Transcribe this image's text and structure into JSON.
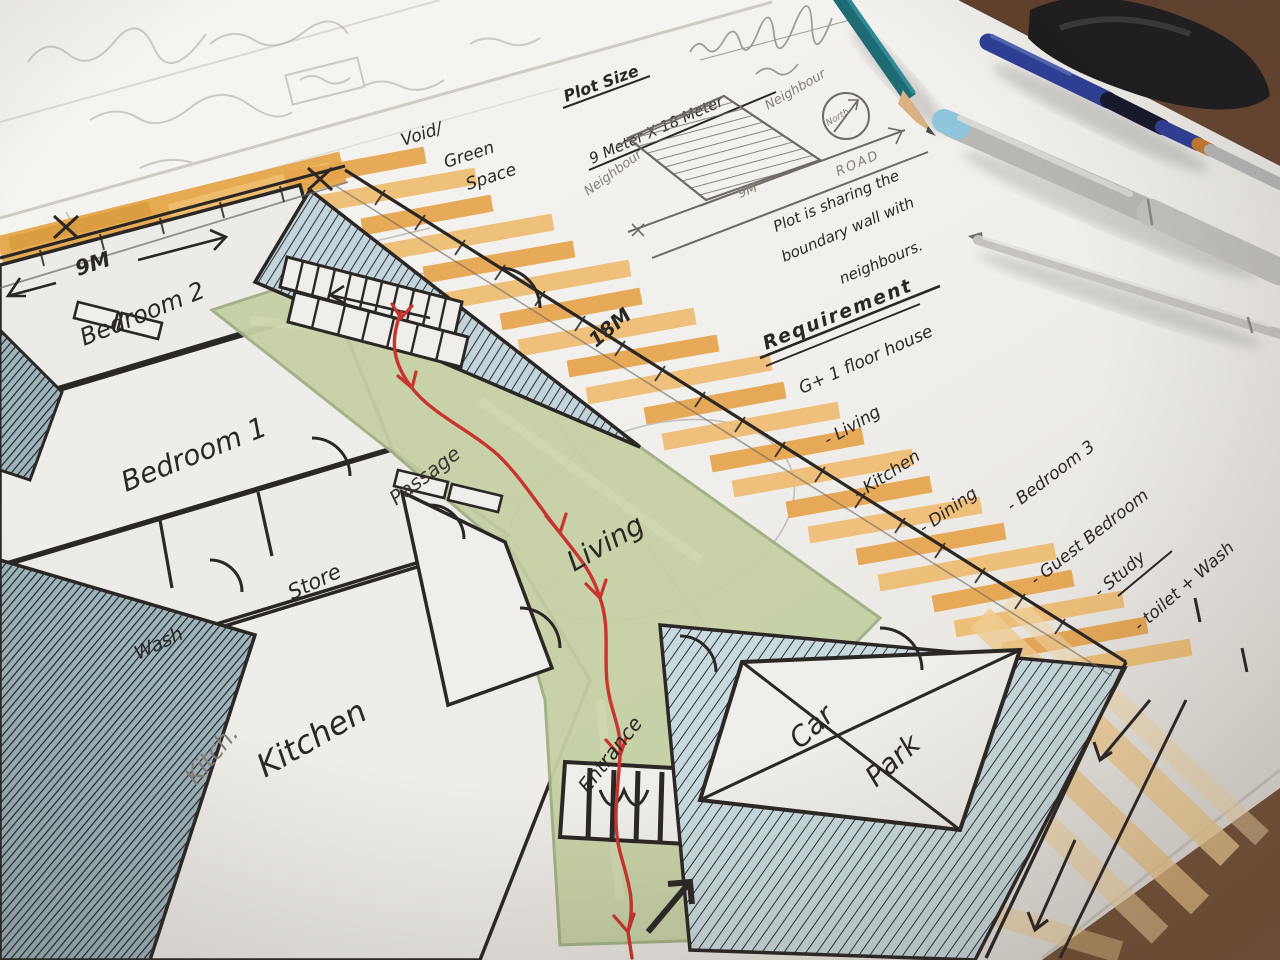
{
  "palette": {
    "desk": "#6b4a33",
    "paper": "#f3f1ed",
    "marker_orange": "#e7a94f",
    "marker_orange_light": "#f0c684",
    "marker_green": "#c6d0a4",
    "marker_teal": "#bdd0d6",
    "ink": "#2b2725",
    "red_pen": "#c8352e",
    "pencil": "#9a948b"
  },
  "plan": {
    "dim_left": "9M",
    "dim_top": "18M",
    "void_lines": [
      "Void/",
      "Green",
      "Space"
    ],
    "rooms": {
      "bedroom2": "Bedroom 2",
      "bedroom1": "Bedroom 1",
      "wash": "Wash",
      "store": "Store",
      "kitchen": "Kitchen",
      "kitchen_pencil": "Kitch.",
      "passage": "Passage",
      "living": "Living",
      "entrance": "Entrance",
      "carpark_line1": "Car",
      "carpark_line2": "Park"
    }
  },
  "plot_note": {
    "title": "Plot Size",
    "size": "9 Meter X 18 Meter",
    "neighbour_left": "Neighbour",
    "neighbour_right": "Neighbour",
    "north": "North",
    "road": "ROAD",
    "dim": "9M",
    "caption": [
      "Plot is sharing the",
      "boundary wall with",
      "neighbours."
    ]
  },
  "requirements": {
    "title": "Requirement",
    "subtitle": "G+ 1 floor house",
    "items": [
      "- Living",
      "- Kitchen",
      "- Dining",
      "- Bedroom 3",
      "- Guest Bedroom",
      "- Study",
      "- toilet + Wash"
    ]
  }
}
